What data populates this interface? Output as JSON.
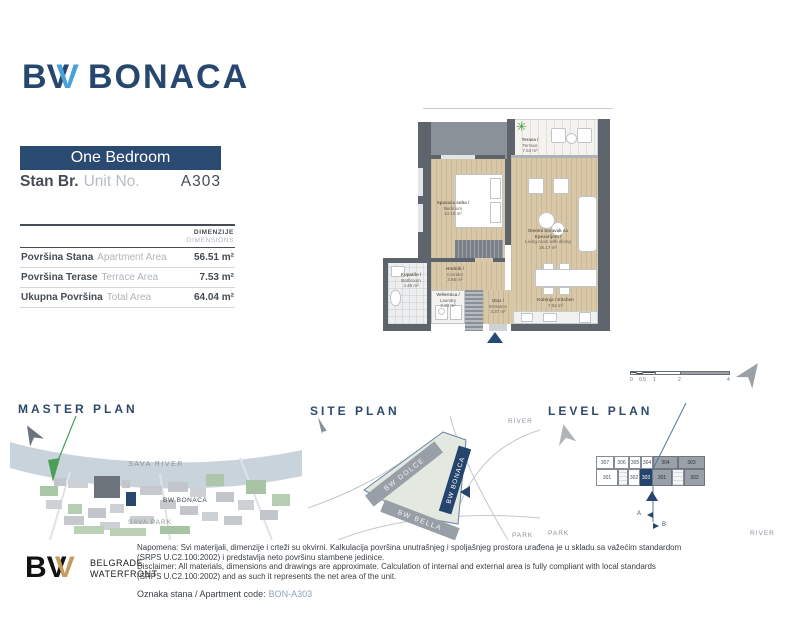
{
  "brand": {
    "logo_b": "B",
    "logo_v1": "V",
    "logo_v2": "V",
    "logo_name": "BONACA"
  },
  "unit": {
    "type_label": "One Bedroom",
    "unit_label_sr": "Stan Br.",
    "unit_label_en": "Unit No.",
    "unit_code": "A303"
  },
  "dimensions_table": {
    "header_sr": "DIMENZIJE",
    "header_en": "DIMENSIONS",
    "rows": [
      {
        "label_sr": "Površina Stana",
        "label_en": "Apartment Area",
        "value": "56.51 m²"
      },
      {
        "label_sr": "Površina Terase",
        "label_en": "Terrace Area",
        "value": "7.53 m²"
      },
      {
        "label_sr": "Ukupna Površina",
        "label_en": "Total Area",
        "value": "64.04 m²"
      }
    ]
  },
  "floor_plan": {
    "rooms": [
      {
        "name_sr": "Terasa /",
        "name_en": "Terrace",
        "area": "7.53 m²"
      },
      {
        "name_sr": "Spavaća soba /",
        "name_en": "Bedroom",
        "area": "14.10 m²"
      },
      {
        "name_sr": "Dnevni boravak sa trpezarijom /",
        "name_en": "Living room with dining",
        "area": "26.17 m²"
      },
      {
        "name_sr": "Kuhinja / Kitchen",
        "name_en": "",
        "area": "7.04 m²"
      },
      {
        "name_sr": "Hodnik /",
        "name_en": "Corridor",
        "area": "3.66 m²"
      },
      {
        "name_sr": "Vešernica /",
        "name_en": "Laundry",
        "area": "2.33 m²"
      },
      {
        "name_sr": "Ulaz /",
        "name_en": "Entrance",
        "area": "3.37 m²"
      },
      {
        "name_sr": "Kupatilo /",
        "name_en": "Bathroom",
        "area": "4.46 m²"
      }
    ],
    "scale_bar": {
      "ticks": [
        "0",
        "0.5",
        "1",
        "2",
        "4"
      ]
    }
  },
  "master_plan": {
    "title": "MASTER PLAN",
    "river_label": "SAVA RIVER",
    "project_label": "BW BONACA",
    "park_label": "SAVA PARK"
  },
  "site_plan": {
    "title": "SITE PLAN",
    "buildings": [
      "BW DOLCE",
      "BW BONACA",
      "BW BELLA"
    ],
    "river_label": "RIVER",
    "park_label": "PARK"
  },
  "level_plan": {
    "title": "LEVEL PLAN",
    "top_units_a": [
      "307",
      "306",
      "305",
      "304"
    ],
    "top_units_b": [
      "304",
      "303"
    ],
    "bottom_units_a": [
      "301",
      "302"
    ],
    "highlighted_unit": "303",
    "bottom_units_b": [
      "301",
      "302"
    ],
    "section_a": "A",
    "section_b": "B",
    "park_label": "PARK",
    "river_label": "RIVER"
  },
  "footer": {
    "logo_b": "B",
    "logo_v1": "V",
    "logo_v2": "V",
    "logo_line1": "BELGRADE",
    "logo_line2": "WATERFRONT",
    "disclaimer_sr_1": "Napomena: Svi materijali, dimenzije i crteži su okvirni. Kalkulacija površina unutrašnjeg i spoljašnjeg prostora urađena je u skladu sa važećim standardom",
    "disclaimer_sr_2": "(SRPS U.C2.100:2002) i predstavlja neto površinu stambene jedinice.",
    "disclaimer_en_1": "Disclaimer: All materials, dimensions and drawings are approximate. Calculation of internal and external area is fully compliant with local standards",
    "disclaimer_en_2": "(SRPS U.C2.100:2002) and as such it represents the net area of the unit.",
    "apartment_code_label": "Oznaka stana / Apartment code:",
    "apartment_code": "BON-A303"
  },
  "colors": {
    "navy": "#27476e",
    "light_blue": "#4aa3d8",
    "gold": "#c59a5c",
    "wall_gray": "#5d646c",
    "floor_beige": "#d9c8a8",
    "river_blue": "#c9d3dc",
    "park_green": "#aec6aa",
    "code_blue": "#8ba3bd"
  }
}
